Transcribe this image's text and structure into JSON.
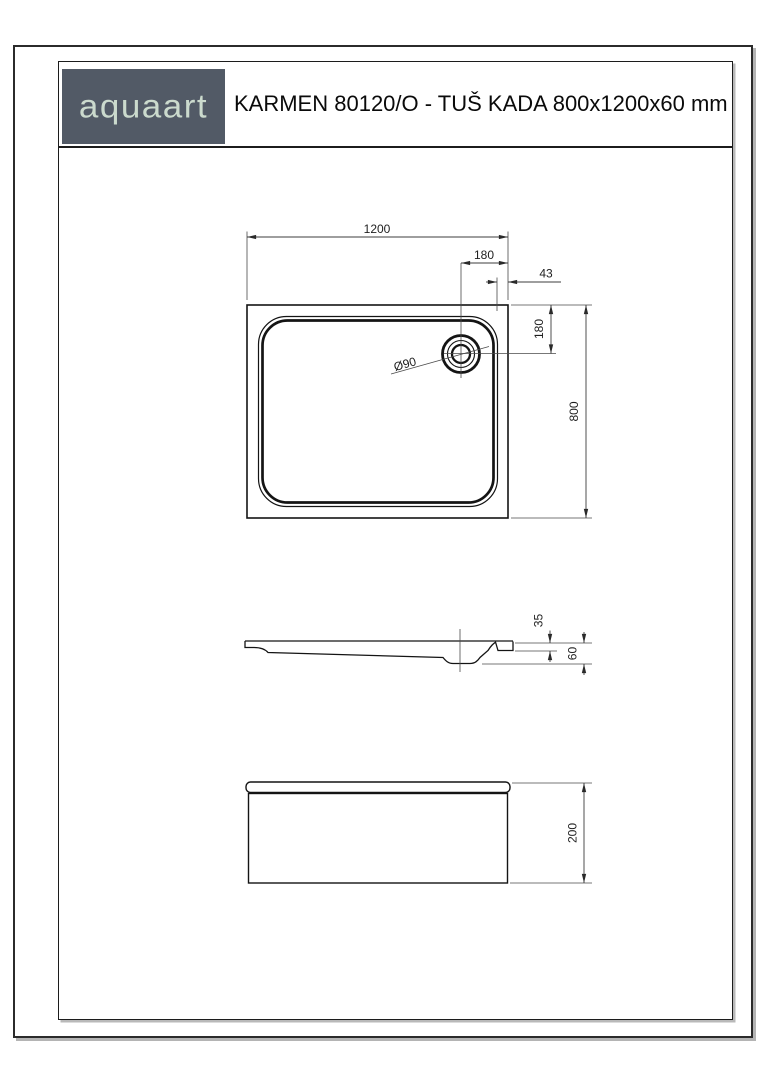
{
  "header": {
    "brand": "aquaart",
    "title": "KARMEN 80120/O - TUŠ KADA 800x1200x60 mm"
  },
  "colors": {
    "logo_bg": "#525a66",
    "logo_text": "#cbdacd",
    "line": "#141414"
  },
  "drawing": {
    "top_view": {
      "width_label": "1200",
      "drain_offset_right": "180",
      "rim_to_edge": "43",
      "drain_offset_top": "180",
      "depth_label": "800",
      "drain_diameter": "Ø90"
    },
    "side_view": {
      "rim_drop": "35",
      "height": "60"
    },
    "front_view": {
      "height": "200"
    }
  }
}
